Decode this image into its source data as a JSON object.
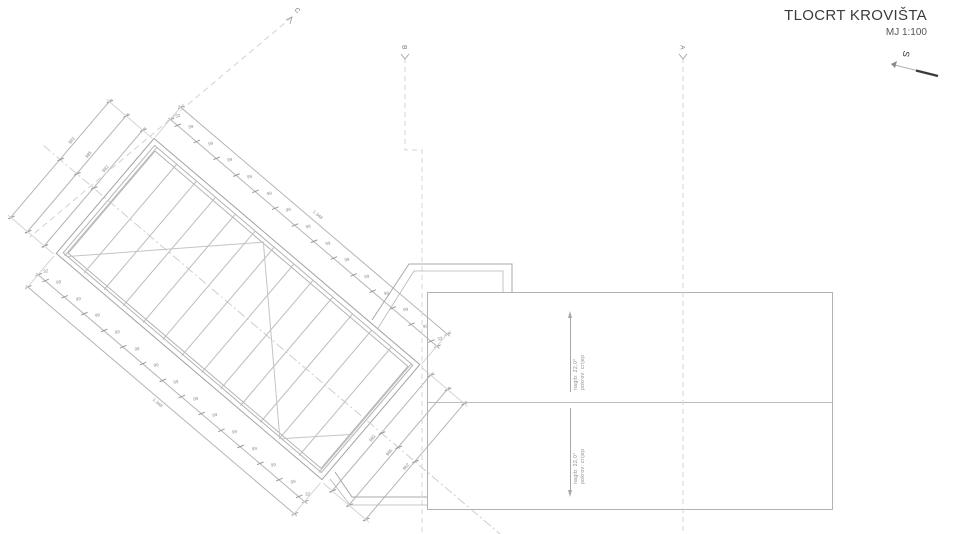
{
  "title": {
    "main": "TLOCRT KROVIŠTA",
    "scale": "MJ 1:100"
  },
  "north_label": "S",
  "section_labels": {
    "a": "A",
    "b": "B",
    "c": "C"
  },
  "left_roof": {
    "total_label": "1.348",
    "edge_label": "32",
    "bay_label": "99",
    "bay_count": 13,
    "end_label_inner": "982",
    "end_label_mid": "985",
    "end_label_outer": "962"
  },
  "right_roof": {
    "slope_label": "nagib: 22,0°",
    "cover_label": "pokrov: crijep"
  },
  "colors": {
    "outline": "#a2a2a2",
    "fine": "#bcbcbc",
    "dim_line": "#b5b5b5",
    "tick": "#999999",
    "dim_text": "#8a8a8a",
    "dashed": "#d2d2d2",
    "title_text": "#3c3c3c"
  }
}
